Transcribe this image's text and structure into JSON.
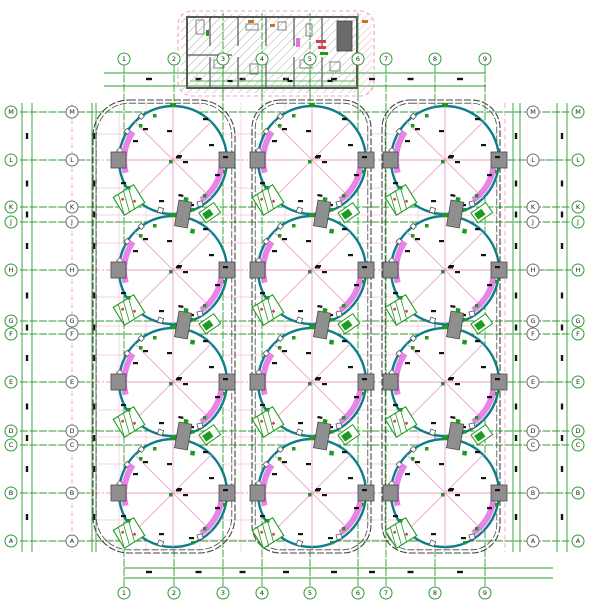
{
  "drawing": {
    "title": "tank-farm-plan-drawing",
    "canvas": {
      "w": 600,
      "h": 600,
      "bg": "#ffffff"
    },
    "colors": {
      "grid_green": "#2f9e2f",
      "pink_axis": "#ef9ec6",
      "pink_fine": "#f7c3da",
      "pink_dash": "#f0a0c4",
      "tank_teal": "#0d7f88",
      "stair_magenta": "#e46ee4",
      "platform_fill": "#8f8f8f",
      "platform_stroke": "#474747",
      "enclosure_wall": "#454545",
      "building_wall": "#585858",
      "hatch_gray": "#ababab",
      "hatch_pink": "#efa8c4",
      "mark_black": "#141414",
      "green_symbol": "#1f9a1f",
      "red_mark": "#cc4444",
      "orange_mark": "#c07830",
      "bubble_gray": "#6f6f6f",
      "bubble_text": "#222222"
    },
    "grid": {
      "bubble_r": 6,
      "columns": {
        "labels": [
          "1",
          "2",
          "3",
          "4",
          "5",
          "6",
          "7",
          "8",
          "9"
        ],
        "x": [
          124,
          174,
          223,
          262,
          310,
          358,
          386,
          435,
          485
        ],
        "line_y1": 65,
        "line_y2": 588,
        "top_bubble_y": 59,
        "bottom_bubble_y": 593
      },
      "rows": {
        "labels": [
          "M",
          "L",
          "K",
          "J",
          "H",
          "G",
          "F",
          "E",
          "D",
          "C",
          "B",
          "A"
        ],
        "y": [
          112,
          160,
          207,
          222,
          270,
          321,
          334,
          382,
          431,
          445,
          493,
          541
        ],
        "line_x1": 20,
        "line_x2": 571,
        "left_outer_x": 11,
        "left_inner_x": 72,
        "right_inner_x": 533,
        "right_outer_x": 578,
        "tank_center_row_indices": [
          1,
          4,
          7,
          10
        ],
        "center_row_green_segments": [
          [
            20,
            90
          ],
          [
            508,
            571
          ]
        ]
      }
    },
    "fine_grid": {
      "h_full": [
        160,
        270,
        382,
        493
      ],
      "h_enc": [
        134,
        188,
        215,
        243,
        297,
        326,
        355,
        410,
        437,
        464,
        520,
        540
      ],
      "h_x1": 90,
      "h_x2": 502,
      "h_full_x1": 58,
      "h_full_x2": 562,
      "v_center": [
        173,
        312,
        445
      ],
      "v_enc": [
        119,
        146,
        200,
        241,
        285,
        339,
        418,
        472
      ],
      "v_dash": [
        72,
        505
      ],
      "v_y1": 103,
      "v_y2": 552
    },
    "dims": {
      "top": {
        "ys": [
          73,
          86
        ],
        "x1": 104,
        "x2": 486,
        "mark_y": 79
      },
      "bottom": {
        "ys": [
          568,
          578
        ],
        "x1": 124,
        "x2": 553,
        "mark_y": 572
      },
      "left": {
        "xs": [
          22,
          32,
          92,
          96
        ],
        "y1": 103,
        "y2": 552,
        "mark_xs": [
          27,
          94
        ]
      },
      "right": {
        "xs": [
          513,
          520,
          557,
          567
        ],
        "y1": 103,
        "y2": 552,
        "mark_xs": [
          516,
          562
        ]
      }
    },
    "enclosures": [
      {
        "x": 93,
        "y": 100,
        "w": 142,
        "h": 453,
        "r": 36
      },
      {
        "x": 252,
        "y": 100,
        "w": 119,
        "h": 453,
        "r": 28
      },
      {
        "x": 382,
        "y": 100,
        "w": 118,
        "h": 453,
        "r": 28
      }
    ],
    "tanks": {
      "cx": [
        173,
        312,
        445
      ],
      "cy": [
        160,
        270,
        382,
        493
      ],
      "r": 54,
      "spoke_angles": [
        0,
        45,
        90,
        135
      ],
      "stair_arcs": [
        {
          "a0": 165,
          "a1": 215
        },
        {
          "a0": 10,
          "a1": 55
        }
      ],
      "arc_r_off": 5,
      "arc_w": 6,
      "rim_tick_angles": [
        190,
        212,
        234
      ],
      "bottom_ticks": [
        {
          "dx": -14,
          "dy": 47,
          "rot": 20
        },
        {
          "dx": 24,
          "dy": 42,
          "rot": -15
        }
      ],
      "platform": {
        "w": 15,
        "h": 16
      },
      "marks": [
        [
          -40,
          -20
        ],
        [
          -30,
          -32
        ],
        [
          4,
          -5
        ],
        [
          10,
          1
        ],
        [
          36,
          -16
        ],
        [
          42,
          14
        ],
        [
          -14,
          40
        ],
        [
          16,
          44
        ],
        [
          30,
          -42
        ],
        [
          -52,
          22
        ],
        [
          50,
          -4
        ],
        [
          -6,
          -30
        ]
      ],
      "green_marks": [
        [
          -20,
          -46
        ],
        [
          -34,
          -36
        ],
        [
          30,
          34
        ],
        [
          18,
          48
        ],
        [
          -46,
          26
        ],
        [
          50,
          10
        ]
      ],
      "hatch_square": {
        "dx": -44,
        "dy": 40,
        "w": 24,
        "h": 21,
        "rot": -32
      },
      "nozzle": {
        "dx": -3,
        "dy": -57,
        "w": 6,
        "h": 4
      },
      "center_mark": {
        "dx": 3,
        "dy": -4,
        "w": 5,
        "h": 2.5
      },
      "center_green": {
        "dx": -4,
        "dy": 0,
        "w": 3.5,
        "h": 3.5
      }
    },
    "tangent_clusters": {
      "ty": [
        215,
        326,
        437
      ],
      "gray": {
        "dx": 10,
        "dy": -14,
        "w": 13,
        "h": 26,
        "rot": 10
      },
      "gray_green_bits": [
        [
          8,
          -18
        ],
        [
          20,
          12
        ]
      ],
      "flag": {
        "dx": 26,
        "dy": -2,
        "w": 18,
        "h": 12,
        "rot": -35
      }
    },
    "building": {
      "border": {
        "x": 178,
        "y": 11,
        "w": 196,
        "h": 85,
        "r": 14
      },
      "hatch_gray_rect": {
        "x": 181,
        "y": 14,
        "w": 176,
        "h": 79
      },
      "hatch_pink_rect": {
        "x": 352,
        "y": 14,
        "w": 20,
        "h": 79
      },
      "wall": {
        "x": 187,
        "y": 17,
        "w": 170,
        "h": 71
      },
      "partitions_x": [
        210,
        238,
        266,
        294,
        322
      ],
      "partition_gap": [
        46,
        57
      ],
      "h_wall": {
        "x1": 188,
        "y": 55,
        "x2": 232
      },
      "dark_block": {
        "x": 337,
        "y": 21,
        "w": 15,
        "h": 30
      },
      "fixtures": [
        [
          196,
          20,
          8,
          14
        ],
        [
          214,
          60,
          10,
          8
        ],
        [
          246,
          24,
          12,
          6
        ],
        [
          250,
          64,
          8,
          10
        ],
        [
          278,
          22,
          8,
          8
        ],
        [
          300,
          60,
          12,
          8
        ],
        [
          306,
          24,
          6,
          12
        ],
        [
          330,
          62,
          10,
          9
        ]
      ],
      "red_marks": [
        [
          316,
          40,
          10,
          3
        ],
        [
          318,
          46,
          8,
          3
        ]
      ],
      "green_marks": [
        [
          320,
          52,
          8,
          3
        ],
        [
          206,
          30,
          3,
          6
        ]
      ],
      "orange_marks": [
        [
          248,
          20,
          6,
          3
        ],
        [
          270,
          24,
          5,
          3
        ],
        [
          362,
          20,
          6,
          3
        ]
      ],
      "magenta_marks": [
        [
          296,
          38,
          4,
          9
        ]
      ],
      "inner_dim": {
        "y": 81,
        "x1": 190,
        "x2": 355,
        "mark_xs": [
          230,
          290,
          330
        ]
      },
      "over_cols_x": [
        223,
        262,
        310,
        358
      ],
      "over_cols_y1": 13,
      "over_cols_y2": 100
    }
  }
}
